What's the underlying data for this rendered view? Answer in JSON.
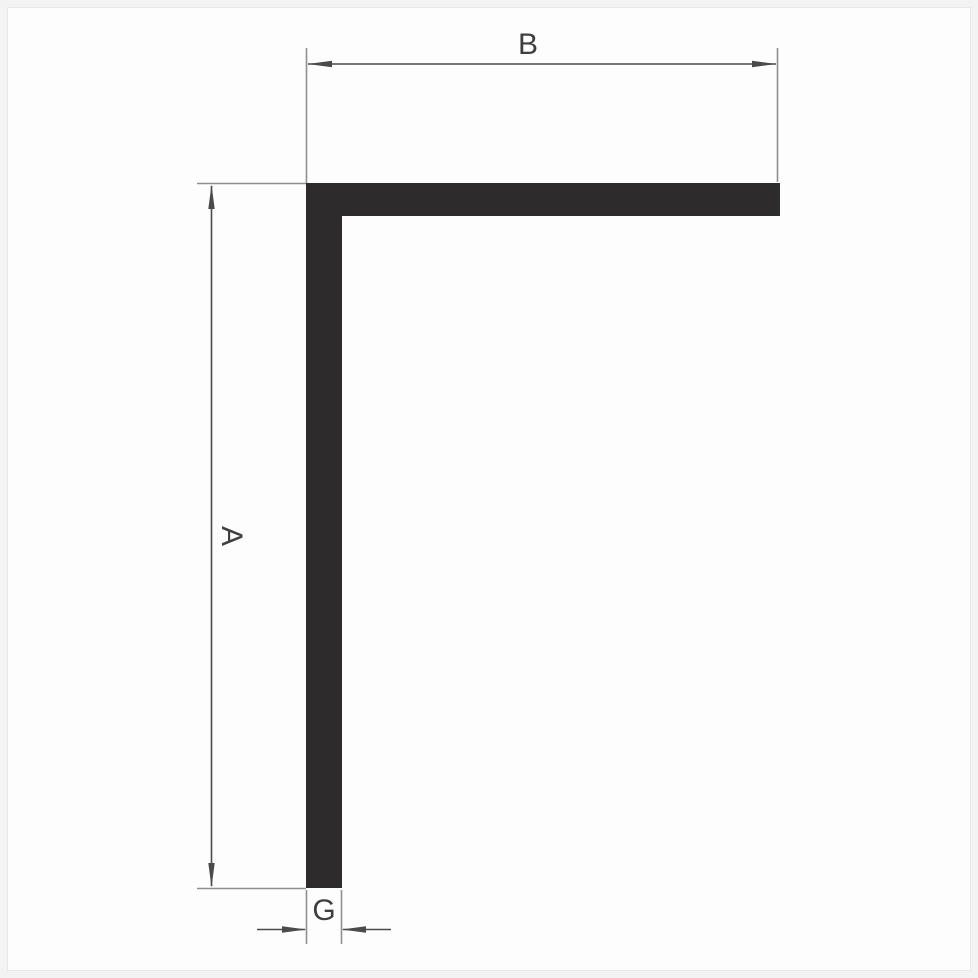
{
  "diagram": {
    "labels": {
      "width_b": "B",
      "height_a": "A",
      "thickness_g": "G"
    },
    "colors": {
      "page_bg": "#f3f3f3",
      "canvas_bg": "#fdfdfd",
      "frame_border": "#e8e8e8",
      "profile": "#2d2b2c",
      "dimension_line": "#4a4a4a",
      "extension_line": "#8f8f8f",
      "text": "#3f3f3f"
    }
  }
}
